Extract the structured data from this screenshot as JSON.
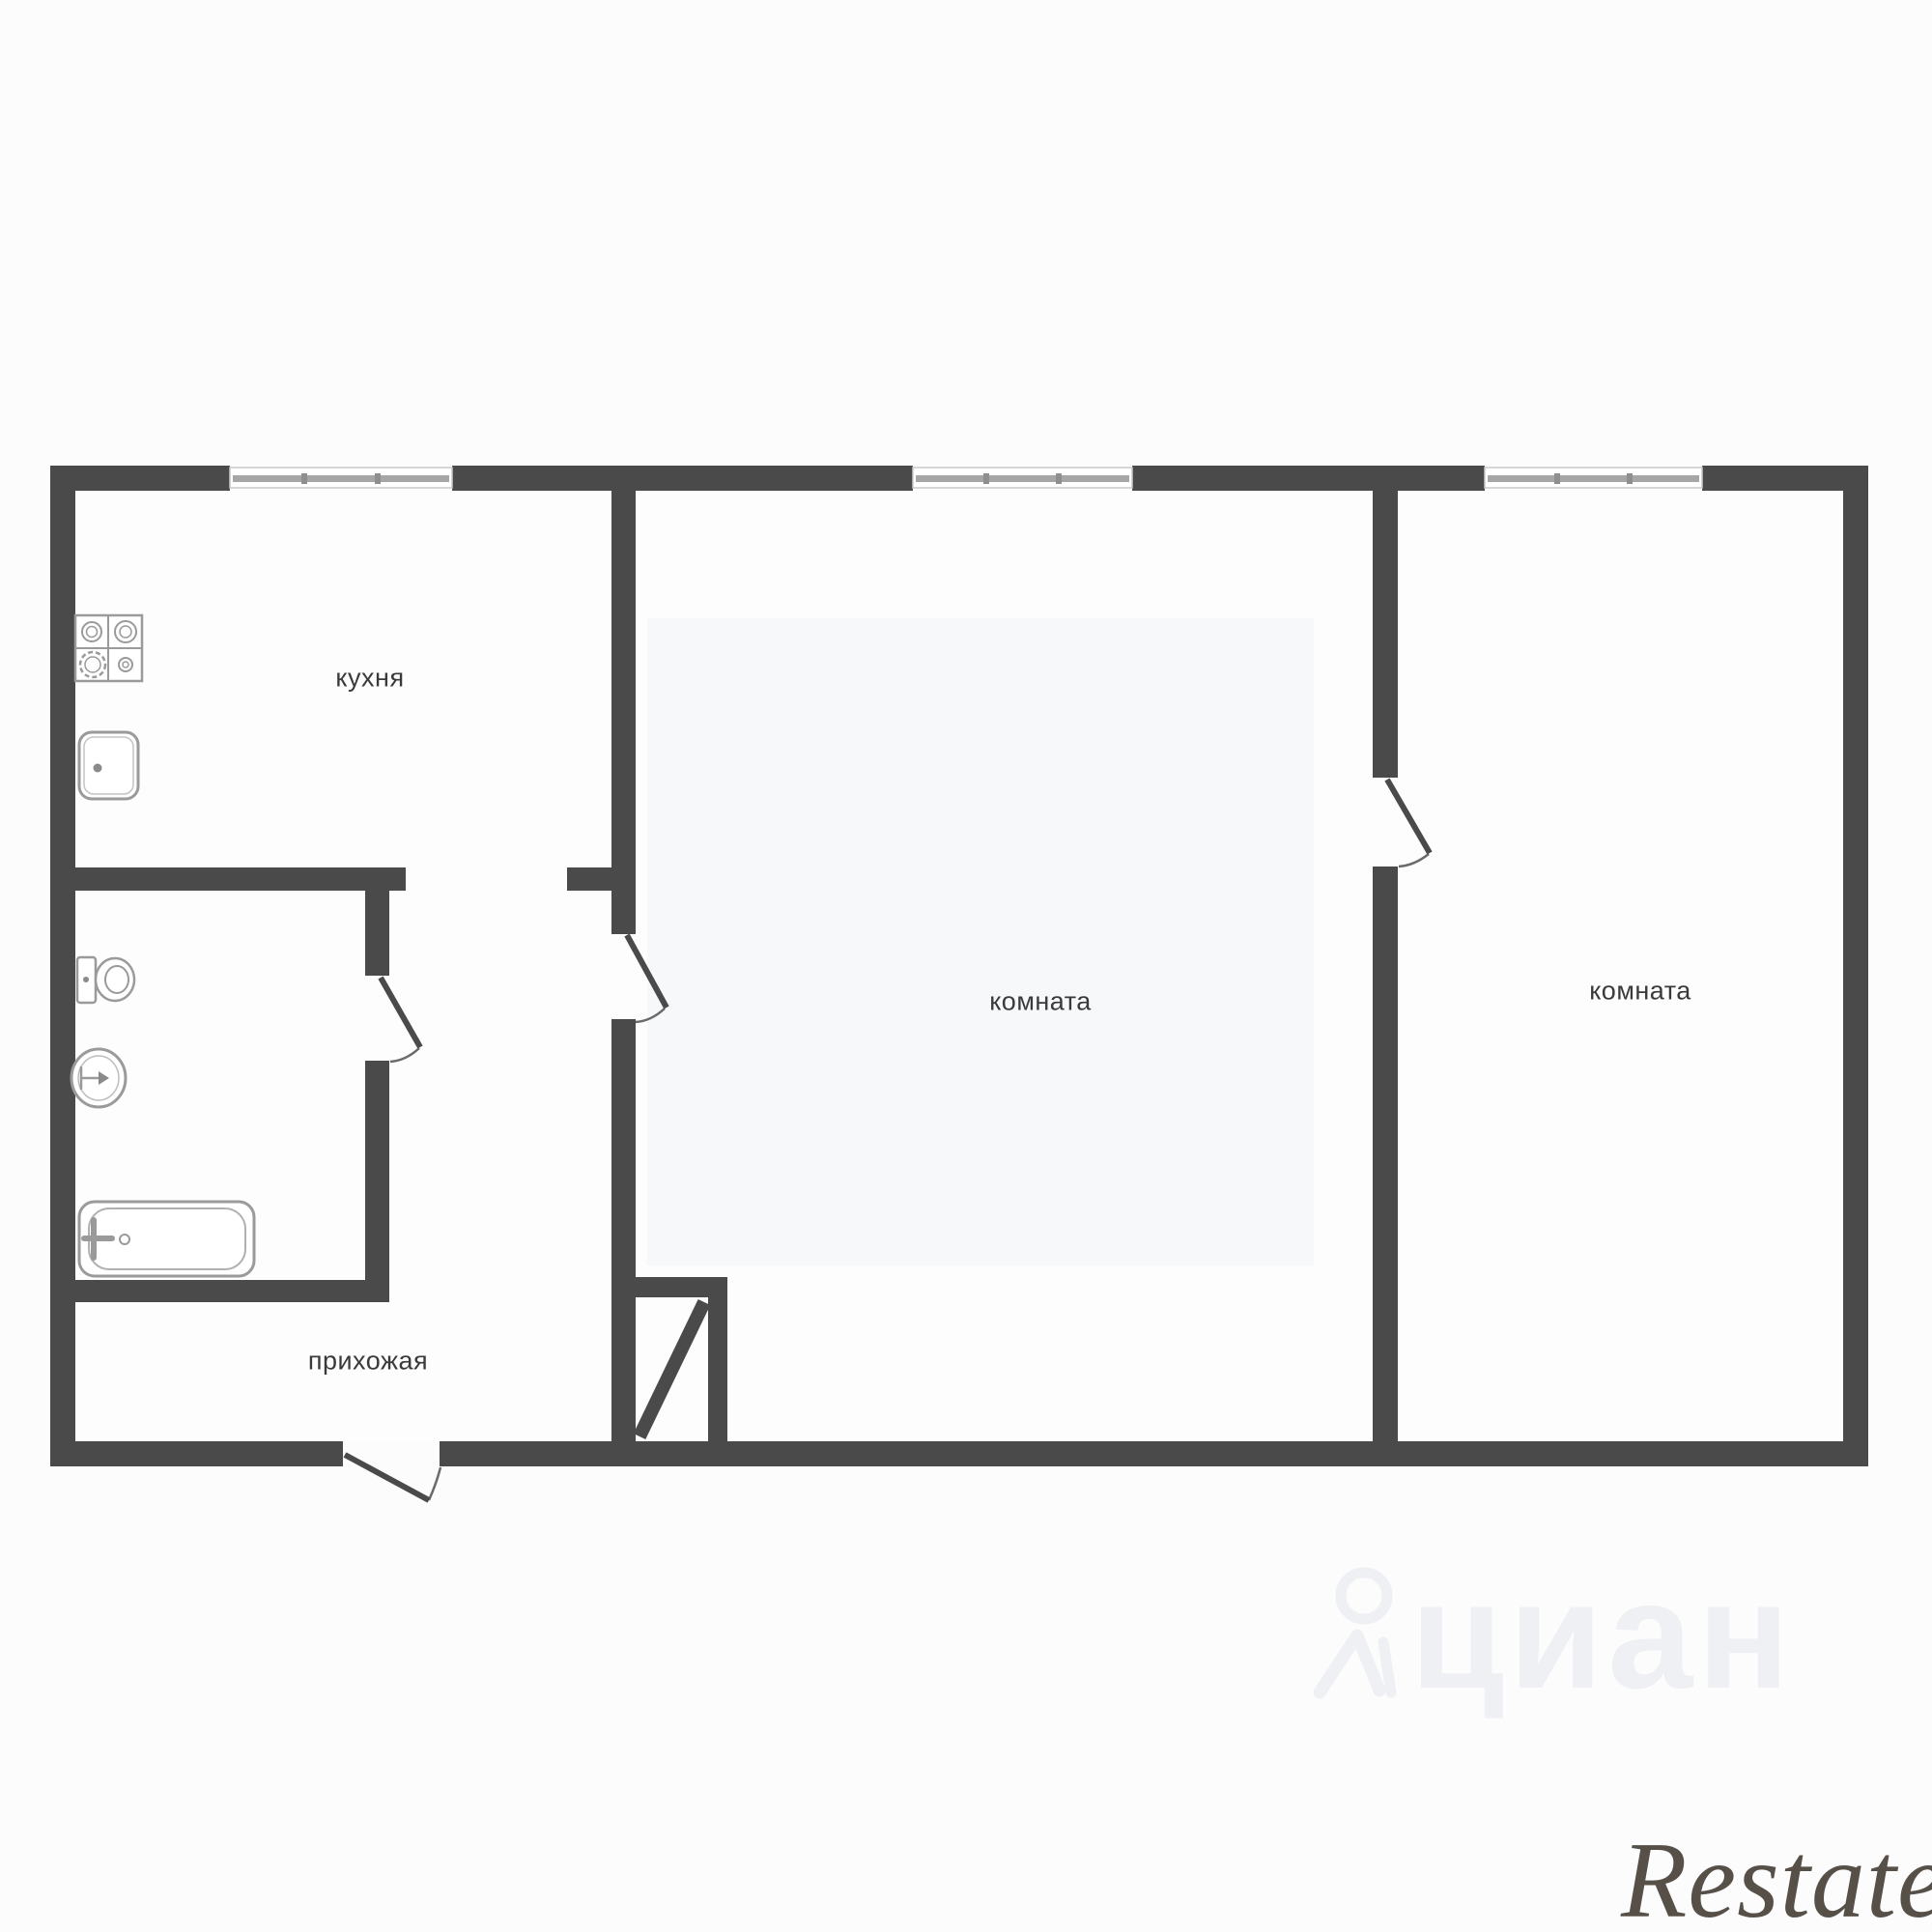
{
  "plan": {
    "type": "apartment-floor-plan",
    "rooms": {
      "kitchen": {
        "label": "кухня"
      },
      "room_main": {
        "label": "комната"
      },
      "room_second": {
        "label": "комната"
      },
      "hallway": {
        "label": "прихожая"
      }
    },
    "fixtures": [
      "stove-icon",
      "kitchen-sink-icon",
      "toilet-icon",
      "washbasin-icon",
      "bathtub-icon",
      "vent-shaft-icon"
    ],
    "doors": 4,
    "windows": 3
  },
  "colors": {
    "wall": "#4a4a4a",
    "door_arc": "#6a6a6a",
    "fixture": "#9a9a9a",
    "fixture_light": "#bdbdbd",
    "window_frame": "#c9c9c9",
    "window_band": "#a6a6a6",
    "window_tick": "#8f8f8f",
    "label": "#3a3a3a",
    "bg": "#fcfcfc",
    "interior": "#fdfdfe",
    "room_tint": "#f7f8fa",
    "watermark_cian": "#eef0f3",
    "watermark_restate": "#575049"
  },
  "watermarks": {
    "cian_text": "циан",
    "restate_text": "Restate"
  }
}
